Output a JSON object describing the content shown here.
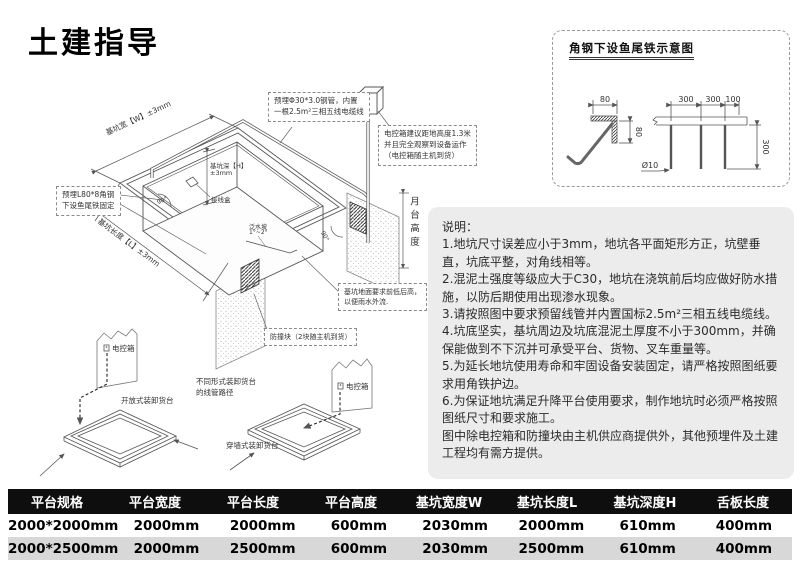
{
  "page": {
    "title": "土建指导"
  },
  "main": {
    "dim_width": "基坑宽【W】±3mm",
    "dim_length": "基坑长度【L】±3mm",
    "dim_depth_1": "基坑深【H】",
    "dim_depth_2": "±3mm",
    "platform_height": "月台高度",
    "junction_box": "接线盒",
    "slope_1": "泛水坡",
    "slope_2": "1°~2°",
    "angle_left": "90°",
    "angle_right": "90°",
    "callout_pipe_1": "预埋Φ30*3.0钢管，内置",
    "callout_pipe_2": "一根2.5m²三相五线电缆线",
    "callout_ctrl_1": "电控箱建议距地高度1.3米",
    "callout_ctrl_2": "并且完全观察到设备运作",
    "callout_ctrl_3": "（电控箱随主机到货）",
    "callout_angle_1": "预埋L80*8角钢",
    "callout_angle_2": "下设鱼尾铁固定",
    "callout_floor_1": "基坑地面要求前低后高，",
    "callout_floor_2": "以便雨水外流.",
    "callout_bumper": "防撞块（2块随主机到货）",
    "ctrl_box_label_open": "电控箱",
    "ctrl_box_label_wall": "电控箱",
    "open_dock_label": "开放式装卸货台",
    "wall_dock_label": "穿墙式装卸货台",
    "conduit_note_1": "不同形式装卸货台",
    "conduit_note_2": "的线管路径"
  },
  "detail": {
    "title": "角钢下设鱼尾铁示意图",
    "dim_top": "80",
    "dim_side": "80",
    "dim_a": "300",
    "dim_b": "300",
    "dim_c": "100",
    "dim_v": "300",
    "dim_dia": "Ø10"
  },
  "notes": {
    "title": "说明：",
    "items": [
      "1.地坑尺寸误差应小于3mm，地坑各平面矩形方正，坑壁垂直，坑底平整，对角线相等。",
      "2.混泥土强度等级应大于C30，地坑在浇筑前后均应做好防水措施，以防后期使用出现渗水现象。",
      "3.请按照图中要求预留线管并内置国标2.5m²三相五线电缆线。",
      "4.坑底坚实，基坑周边及坑底混泥土厚度不小于300mm，并确保能做到不下沉并可承受平台、货物、叉车重量等。",
      "5.为延长地坑使用寿命和牢固设备安装固定，请严格按照图纸要求用角铁护边。",
      "6.为保证地坑满足升降平台使用要求，制作地坑时必须严格按照图纸尺寸和要求施工。",
      "图中除电控箱和防撞块由主机供应商提供外，其他预埋件及土建工程均有需方提供。"
    ]
  },
  "table": {
    "headers": [
      "平台规格",
      "平台宽度",
      "平台长度",
      "平台高度",
      "基坑宽度W",
      "基坑长度L",
      "基坑深度H",
      "舌板长度"
    ],
    "rows": [
      [
        "2000*2000mm",
        "2000mm",
        "2000mm",
        "600mm",
        "2030mm",
        "2000mm",
        "610mm",
        "400mm"
      ],
      [
        "2000*2500mm",
        "2000mm",
        "2500mm",
        "600mm",
        "2030mm",
        "2500mm",
        "610mm",
        "400mm"
      ]
    ]
  }
}
